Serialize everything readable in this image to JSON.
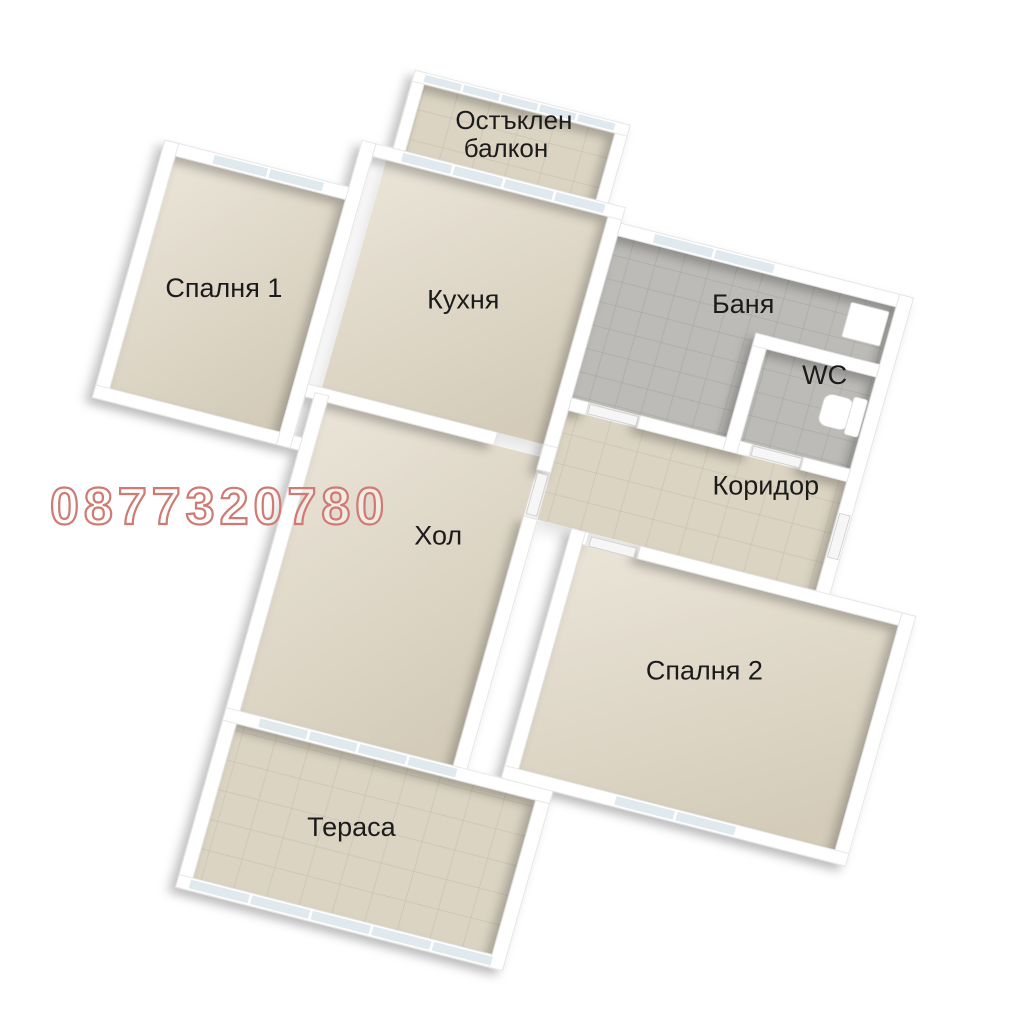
{
  "watermark": {
    "phone": "0877320780",
    "color": "#cf7a72"
  },
  "rooms": [
    {
      "id": "balcony",
      "label": "Остъклен балкон",
      "lines": [
        "Остъклен",
        "балкон"
      ]
    },
    {
      "id": "bedroom1",
      "label": "Спалня 1"
    },
    {
      "id": "kitchen",
      "label": "Кухня"
    },
    {
      "id": "bathroom",
      "label": "Баня"
    },
    {
      "id": "wc",
      "label": "WC"
    },
    {
      "id": "corridor",
      "label": "Коридор"
    },
    {
      "id": "living",
      "label": "Хол"
    },
    {
      "id": "bedroom2",
      "label": "Спалня 2"
    },
    {
      "id": "terrace",
      "label": "Тераса"
    }
  ],
  "palette": {
    "background": "#ffffff",
    "wall": "#ffffff",
    "wall_edge": "#e2e2e2",
    "floor_beige_light": "#eae4d8",
    "floor_beige_dark": "#d4ccb9",
    "tile_beige": "#dbd4c3",
    "tile_beige_line": "#c7bfac",
    "tile_gray": "#bcbbb8",
    "tile_gray_line": "#a7a6a3",
    "glass": "#dfe9ee",
    "label_text": "#1b1b1b"
  }
}
